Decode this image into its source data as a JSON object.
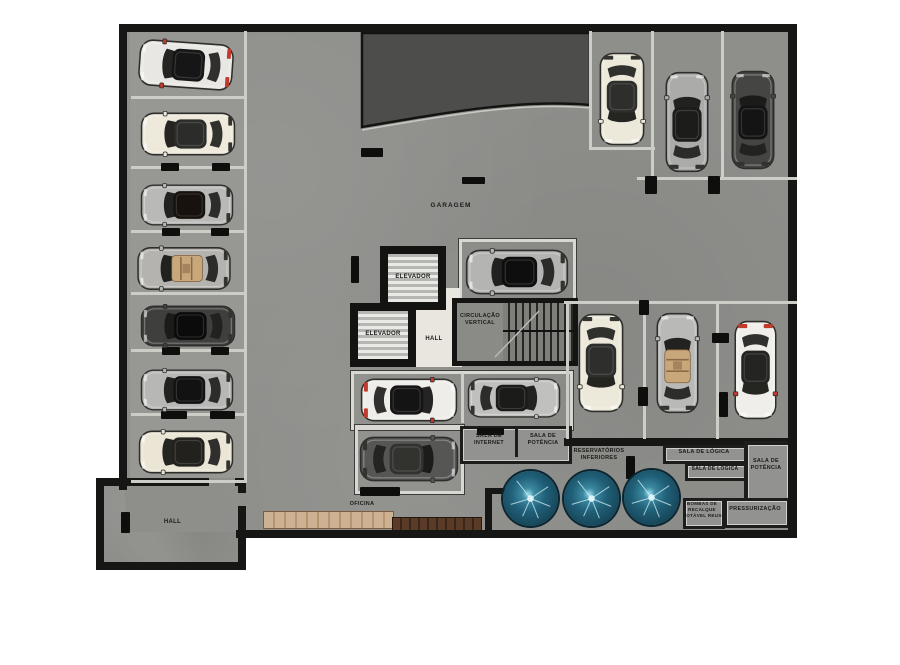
{
  "plan_type": "garage-floor-plan",
  "labels": {
    "garagem": "GARAGEM",
    "elevador_upper": "ELEVADOR",
    "elevador_lower": "ELEVADOR",
    "hall_core": "HALL",
    "circulacao_l1": "CIRCULAÇÃO",
    "circulacao_l2": "VERTICAL",
    "sala_internet_l1": "SALA DE",
    "sala_internet_l2": "INTERNET",
    "sala_potencia_a_l1": "SALA DE",
    "sala_potencia_a_l2": "POTÊNCIA",
    "reservatorios_l1": "RESERVATÓRIOS",
    "reservatorios_l2": "INFERIORES",
    "sala_logica_1": "SALA DE LÓGICA",
    "sala_logica_2": "SALA DE LÓGICA",
    "sala_potencia_b_l1": "SALA DE",
    "sala_potencia_b_l2": "POTÊNCIA",
    "bombas_l1": "BOMBAS DE",
    "bombas_l2": "RECALQUE",
    "bombas_l3": "POTÁVEL REUSO",
    "pressurizacao": "PRESSURIZAÇÃO",
    "oficina": "OFICINA",
    "hall_ext": "HALL"
  },
  "colors": {
    "floor": "#8e8e8b",
    "wall": "#161614",
    "ramp": "#4d4d4b",
    "tank": "#206078",
    "stall_line": "#cdcdc8",
    "hall_floor": "#e9e6df",
    "accent_red": "#c23a2c",
    "wood_light": "#ccb192",
    "wood_dark": "#5a3b28"
  },
  "geometry": {
    "cars": [
      {
        "x": 186,
        "y": 65,
        "l": 96,
        "w": 50,
        "rot": -86,
        "body": "#e9e7e3",
        "roof": "#161616",
        "accent": true
      },
      {
        "x": 188,
        "y": 134,
        "l": 96,
        "w": 46,
        "rot": -90,
        "body": "#eee9db",
        "roof": "#2c2c2a"
      },
      {
        "x": 187,
        "y": 205,
        "l": 94,
        "w": 44,
        "rot": -90,
        "body": "#b9b9b7",
        "roof": "#17120d"
      },
      {
        "x": 184,
        "y": 268,
        "l": 95,
        "w": 46,
        "rot": -90,
        "body": "#b5b3af",
        "open": true
      },
      {
        "x": 188,
        "y": 326,
        "l": 96,
        "w": 44,
        "rot": -90,
        "body": "#3f3f3d",
        "roof": "#0b0b0b"
      },
      {
        "x": 187,
        "y": 390,
        "l": 94,
        "w": 44,
        "rot": -90,
        "body": "#b7b7b5",
        "roof": "#121212"
      },
      {
        "x": 186,
        "y": 452,
        "l": 96,
        "w": 46,
        "rot": -90,
        "body": "#eae5d5",
        "roof": "#23211d"
      },
      {
        "x": 622,
        "y": 99,
        "l": 94,
        "w": 48,
        "rot": 180,
        "body": "#ece8da",
        "roof": "#2e2e2c"
      },
      {
        "x": 687,
        "y": 122,
        "l": 102,
        "w": 46,
        "rot": 0,
        "body": "#ababa9",
        "roof": "#1c1c1a"
      },
      {
        "x": 753,
        "y": 120,
        "l": 100,
        "w": 46,
        "rot": 0,
        "body": "#454543",
        "roof": "#141414"
      },
      {
        "x": 517,
        "y": 272,
        "l": 104,
        "w": 48,
        "rot": -90,
        "body": "#b4b4b2",
        "roof": "#0e0e0e"
      },
      {
        "x": 601,
        "y": 363,
        "l": 100,
        "w": 48,
        "rot": 180,
        "body": "#ece8da",
        "roof": "#2e2e2c"
      },
      {
        "x": 677,
        "y": 363,
        "l": 102,
        "w": 45,
        "rot": 0,
        "body": "#b9b9b7",
        "open": true
      },
      {
        "x": 755,
        "y": 370,
        "l": 100,
        "w": 45,
        "rot": 180,
        "body": "#efeeea",
        "roof": "#242422",
        "accent": true
      },
      {
        "x": 409,
        "y": 400,
        "l": 98,
        "w": 46,
        "rot": 90,
        "body": "#efede9",
        "roof": "#141414",
        "accent": true
      },
      {
        "x": 514,
        "y": 398,
        "l": 94,
        "w": 42,
        "rot": 90,
        "body": "#c0c0be",
        "roof": "#1b1b19"
      },
      {
        "x": 409,
        "y": 459,
        "l": 100,
        "w": 48,
        "rot": 90,
        "body": "#565654",
        "roof": "#32322f"
      }
    ],
    "pillars": [
      {
        "x": 161,
        "y": 163,
        "w": 18,
        "h": 8
      },
      {
        "x": 212,
        "y": 163,
        "w": 18,
        "h": 8
      },
      {
        "x": 162,
        "y": 228,
        "w": 18,
        "h": 8
      },
      {
        "x": 211,
        "y": 228,
        "w": 18,
        "h": 8
      },
      {
        "x": 162,
        "y": 347,
        "w": 18,
        "h": 8
      },
      {
        "x": 211,
        "y": 347,
        "w": 18,
        "h": 8
      },
      {
        "x": 161,
        "y": 411,
        "w": 26,
        "h": 8
      },
      {
        "x": 210,
        "y": 411,
        "w": 25,
        "h": 8
      },
      {
        "x": 351,
        "y": 256,
        "w": 8,
        "h": 27
      },
      {
        "x": 361,
        "y": 148,
        "w": 22,
        "h": 9
      },
      {
        "x": 462,
        "y": 177,
        "w": 23,
        "h": 7
      },
      {
        "x": 477,
        "y": 428,
        "w": 27,
        "h": 7
      },
      {
        "x": 626,
        "y": 456,
        "w": 9,
        "h": 23
      },
      {
        "x": 645,
        "y": 176,
        "w": 12,
        "h": 18
      },
      {
        "x": 708,
        "y": 176,
        "w": 12,
        "h": 18
      },
      {
        "x": 639,
        "y": 300,
        "w": 10,
        "h": 15
      },
      {
        "x": 638,
        "y": 387,
        "w": 10,
        "h": 19
      },
      {
        "x": 712,
        "y": 333,
        "w": 17,
        "h": 10
      },
      {
        "x": 719,
        "y": 392,
        "w": 9,
        "h": 25
      },
      {
        "x": 121,
        "y": 512,
        "w": 9,
        "h": 21
      }
    ],
    "stall_lines": [
      {
        "x": 131,
        "y": 96,
        "w": 116,
        "h": 3
      },
      {
        "x": 131,
        "y": 166,
        "w": 116,
        "h": 3
      },
      {
        "x": 131,
        "y": 230,
        "w": 116,
        "h": 3
      },
      {
        "x": 131,
        "y": 292,
        "w": 116,
        "h": 3
      },
      {
        "x": 131,
        "y": 349,
        "w": 116,
        "h": 3
      },
      {
        "x": 131,
        "y": 413,
        "w": 116,
        "h": 3
      },
      {
        "x": 131,
        "y": 480,
        "w": 116,
        "h": 3
      },
      {
        "x": 244,
        "y": 31,
        "w": 3,
        "h": 450
      },
      {
        "x": 589,
        "y": 31,
        "w": 3,
        "h": 118
      },
      {
        "x": 651,
        "y": 31,
        "w": 3,
        "h": 148
      },
      {
        "x": 721,
        "y": 31,
        "w": 3,
        "h": 148
      },
      {
        "x": 589,
        "y": 147,
        "w": 66,
        "h": 3
      },
      {
        "x": 637,
        "y": 177,
        "w": 160,
        "h": 3
      },
      {
        "x": 564,
        "y": 301,
        "w": 233,
        "h": 3
      },
      {
        "x": 566,
        "y": 304,
        "w": 3,
        "h": 135
      },
      {
        "x": 643,
        "y": 304,
        "w": 3,
        "h": 135
      },
      {
        "x": 716,
        "y": 304,
        "w": 3,
        "h": 135
      }
    ],
    "tanks": [
      {
        "x": 530,
        "y": 498
      },
      {
        "x": 591,
        "y": 498
      },
      {
        "x": 651,
        "y": 497
      }
    ]
  }
}
